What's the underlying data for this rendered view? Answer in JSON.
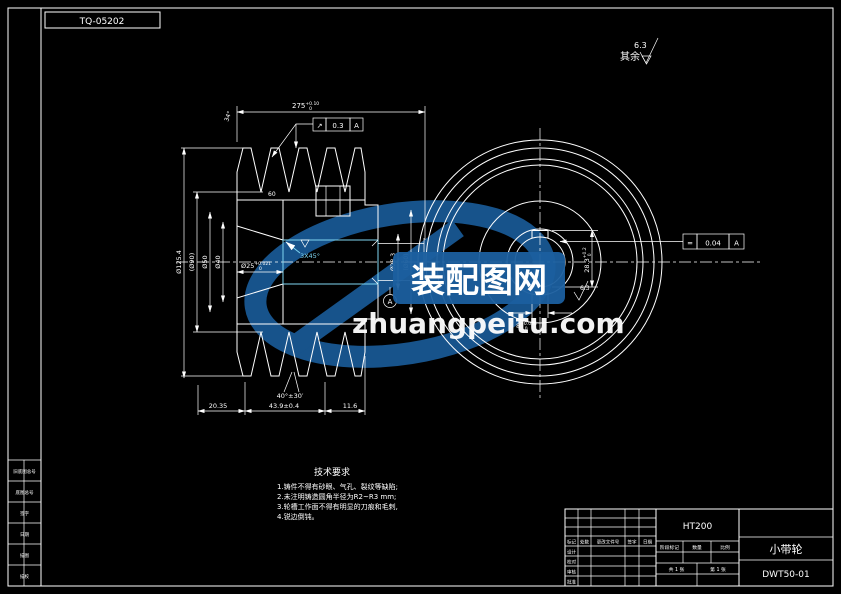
{
  "sheet": {
    "doc_number": "TQ-05202",
    "surface_note": "其余",
    "surface_value": "6.3"
  },
  "left_view": {
    "top_width": {
      "main": "275",
      "sup": "+0.10",
      "sub": "0"
    },
    "gdt": {
      "symbol": "↗",
      "value": "0.3",
      "datum": "A"
    },
    "angle_top": "34°",
    "left_dims": [
      "Ø125.4",
      "(Ø90)",
      "Ø50",
      "Ø40"
    ],
    "bore": {
      "main": "Ø25",
      "sup": "+0.021",
      "sub": "0"
    },
    "chamfer": "3X45°",
    "hub_width": "60",
    "bottom_dims": [
      "20.35",
      "43.9±0.4",
      "11.6"
    ],
    "groove_angle": "40°±30′",
    "right_dims": [
      "Ø28.3",
      "(Ø60)"
    ],
    "datum": "A"
  },
  "right_view": {
    "keyway_depth": {
      "main": "28.3",
      "sup": "+0.2",
      "sub": "0"
    },
    "keyway_width": {
      "main": "8",
      "sup": "+0.036",
      "sub": "0"
    },
    "gdt": {
      "symbol": "=",
      "value": "0.04",
      "datum": "A"
    },
    "roughness": "6.3"
  },
  "tech_req": {
    "title": "技术要求",
    "lines": [
      "1.铸件不得有砂眼、气孔、裂纹等缺陷;",
      "2.未注明铸造圆角半径为R2~R3 mm;",
      "3.轮槽工作面不得有明显的刀痕和毛刺,",
      "4.锐边倒钝。"
    ]
  },
  "title_block": {
    "material": "HT200",
    "part_name": "小带轮",
    "drawing_no": "DWT50-01",
    "rev_headers": [
      "标记",
      "处数",
      "更改文件号",
      "签字",
      "日期"
    ],
    "sign_rows": [
      "设计",
      "校对",
      "审核",
      "批准"
    ],
    "mid_headers": [
      "阶段标记",
      "数量",
      "比例"
    ],
    "sheet_info": [
      "共 1 张",
      "第 1 张"
    ]
  },
  "side_strip": {
    "rows": [
      "旧底图总号",
      "底图总号",
      "签字",
      "日期",
      "描图",
      "描校"
    ]
  },
  "watermark": {
    "cn_name": "装配图网",
    "site": "zhuangpeitu.com",
    "brand_color": "#1b5f9f"
  }
}
